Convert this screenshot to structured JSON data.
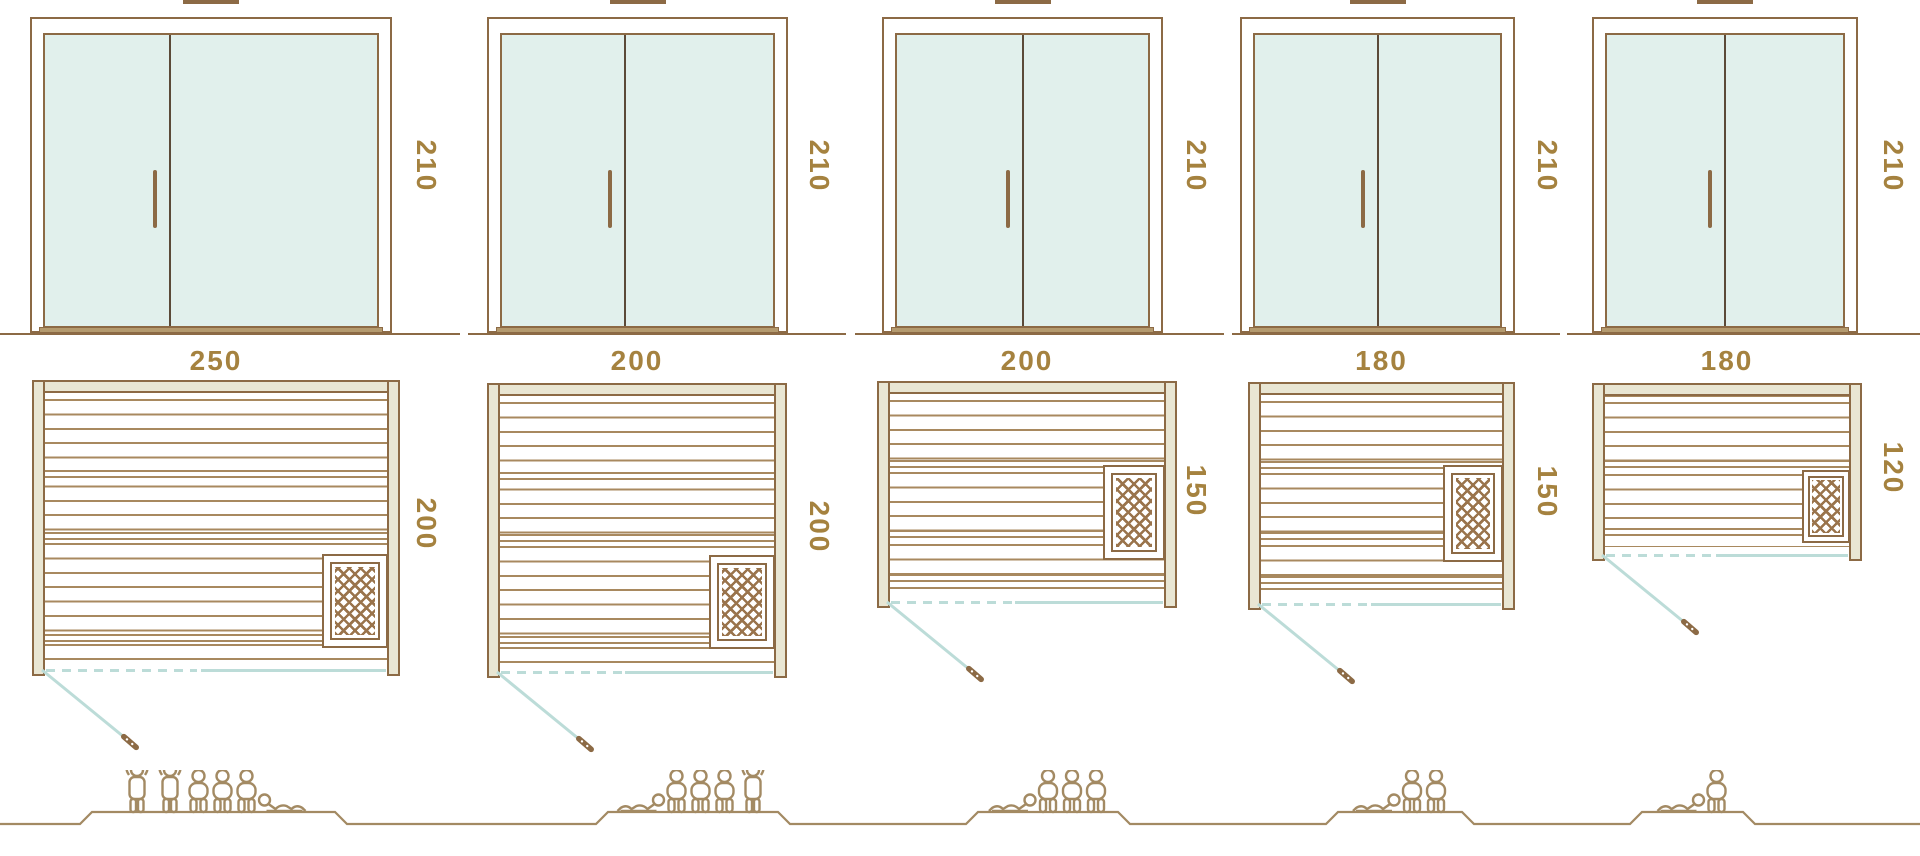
{
  "colors": {
    "bg": "#ffffff",
    "brown": "#8c6a45",
    "gold": "#a5823f",
    "beige": "#e9e6d3",
    "glass": "#e1f0ec",
    "teal": "#bcdcd8",
    "plank": "#a8895f",
    "divider": "#5b4a38",
    "hatch": "#9a744c",
    "people": "#a38a63"
  },
  "units": "cm",
  "cabins": [
    {
      "name": "cabin-250x200",
      "door_height_cm": "210",
      "plan_width_cm": "250",
      "plan_depth_cm": "200",
      "capacity": {
        "standing": 2,
        "seated": 3,
        "lying": 1,
        "total": 6
      },
      "figures": [
        "standing",
        "standing",
        "seated",
        "seated",
        "seated",
        "lying"
      ]
    },
    {
      "name": "cabin-200x200",
      "door_height_cm": "210",
      "plan_width_cm": "200",
      "plan_depth_cm": "200",
      "capacity": {
        "standing": 1,
        "seated": 3,
        "lying": 1,
        "total": 5
      },
      "figures": [
        "lying",
        "seated",
        "seated",
        "seated",
        "standing"
      ]
    },
    {
      "name": "cabin-200x150",
      "door_height_cm": "210",
      "plan_width_cm": "200",
      "plan_depth_cm": "150",
      "capacity": {
        "standing": 0,
        "seated": 3,
        "lying": 1,
        "total": 4
      },
      "figures": [
        "lying",
        "seated",
        "seated",
        "seated"
      ]
    },
    {
      "name": "cabin-180x150",
      "door_height_cm": "210",
      "plan_width_cm": "180",
      "plan_depth_cm": "150",
      "capacity": {
        "standing": 0,
        "seated": 2,
        "lying": 1,
        "total": 3
      },
      "figures": [
        "lying",
        "seated",
        "seated"
      ]
    },
    {
      "name": "cabin-180x120",
      "door_height_cm": "210",
      "plan_width_cm": "180",
      "plan_depth_cm": "120",
      "capacity": {
        "standing": 0,
        "seated": 1,
        "lying": 1,
        "total": 2
      },
      "figures": [
        "lying",
        "seated"
      ]
    }
  ],
  "icons": {
    "heater-icon": "crosshatched square: sauna heater in plan view",
    "door-swing-icon": "diagonal line with handle: glass door opening direction",
    "door-handle-icon": "vertical bar door pull on glass door",
    "roof-vent-icon": "small block above door top (cropped by image edge)",
    "person-standing-icon": "standing bather outline",
    "person-seated-icon": "seated bather outline",
    "person-lying-icon": "reclining bather outline"
  }
}
